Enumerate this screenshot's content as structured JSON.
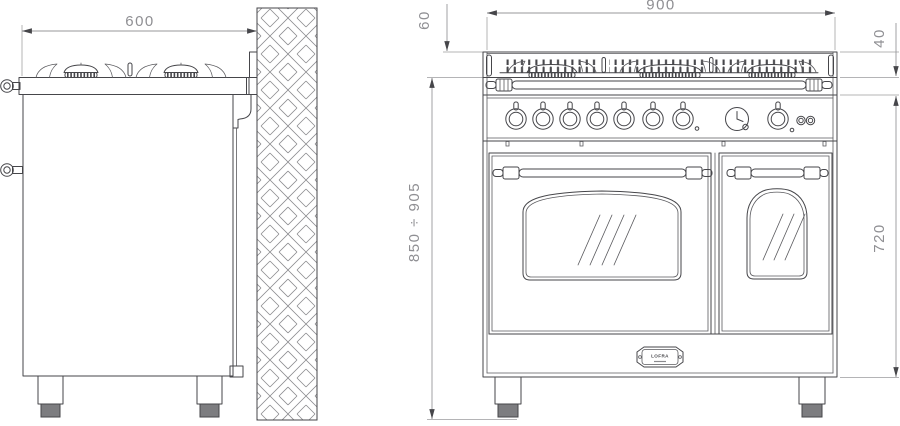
{
  "drawing_type": "range-cooker installation drawing, side and front elevation",
  "colors": {
    "background": "#ffffff",
    "object_lines": "#46464a",
    "dimension_lines": "#97979a",
    "dimension_text": "#8f8f93",
    "wall_hatch": "#8a8a8e",
    "foot_fill": "#7d7d80"
  },
  "dims": {
    "depth": "600",
    "width": "900",
    "offset_top": "60",
    "backguard": "40",
    "height_range": "850 ÷ 905",
    "body_height": "720"
  },
  "badge": {
    "brand": "LOFRA"
  }
}
